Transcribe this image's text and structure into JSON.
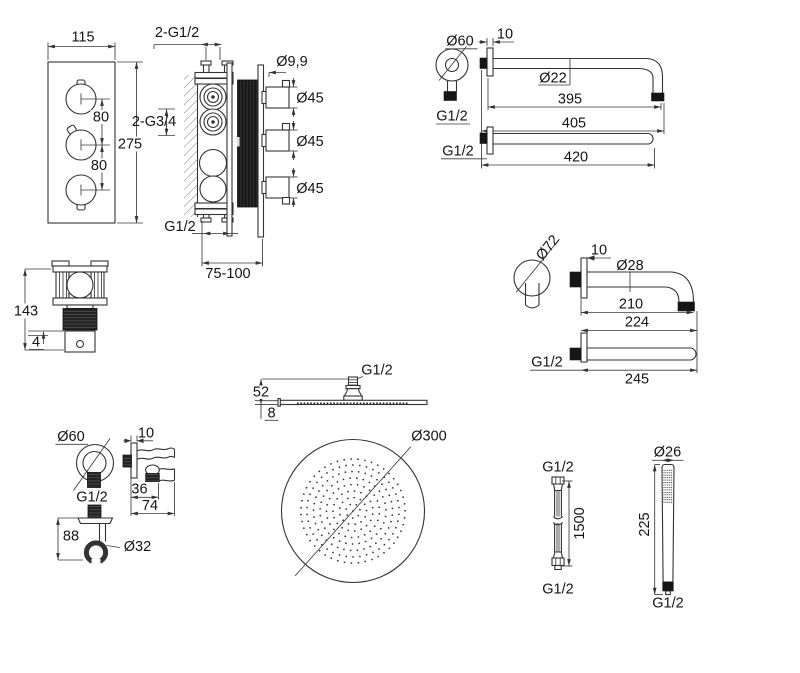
{
  "drawing": {
    "type": "technical-dimension-drawing",
    "background": "#ffffff",
    "line_color": "#333333",
    "fill_color": "#161616"
  },
  "components": {
    "valve_front": {
      "width": "115",
      "height": "275",
      "pitch1": "80",
      "pitch2": "80"
    },
    "valve_side": {
      "inlets": "2-G1/2",
      "ports": "2-G3/4",
      "outlet": "G1/2",
      "depth": "75-100",
      "screw": "Ø9,9",
      "handle1": "Ø45",
      "handle2": "Ø45",
      "handle3": "Ø45"
    },
    "valve_bottom": {
      "height": "143",
      "gap": "4"
    },
    "arm_long": {
      "flange": "Ø60",
      "wall_gap": "10",
      "flange_thread": "G1/2",
      "pipe": "Ø22",
      "len_bend": "395",
      "len_total": "405",
      "thread2": "G1/2",
      "len_straight": "420"
    },
    "arm_short": {
      "flange": "Ø72",
      "wall_gap": "10",
      "pipe": "Ø28",
      "len_bend": "210",
      "len_total": "224",
      "thread": "G1/2",
      "len_straight": "245"
    },
    "head": {
      "thread": "G1/2",
      "height": "52",
      "thickness": "8",
      "diameter": "Ø300"
    },
    "outlet": {
      "flange": "Ø60",
      "wall_gap": "10",
      "thread": "G1/2",
      "depth1": "36",
      "depth2": "74",
      "height": "88",
      "plate": "Ø32"
    },
    "hose": {
      "thread_top": "G1/2",
      "length": "1500",
      "thread_bottom": "G1/2"
    },
    "handshower": {
      "diameter": "Ø26",
      "length": "225",
      "thread": "G1/2"
    }
  }
}
